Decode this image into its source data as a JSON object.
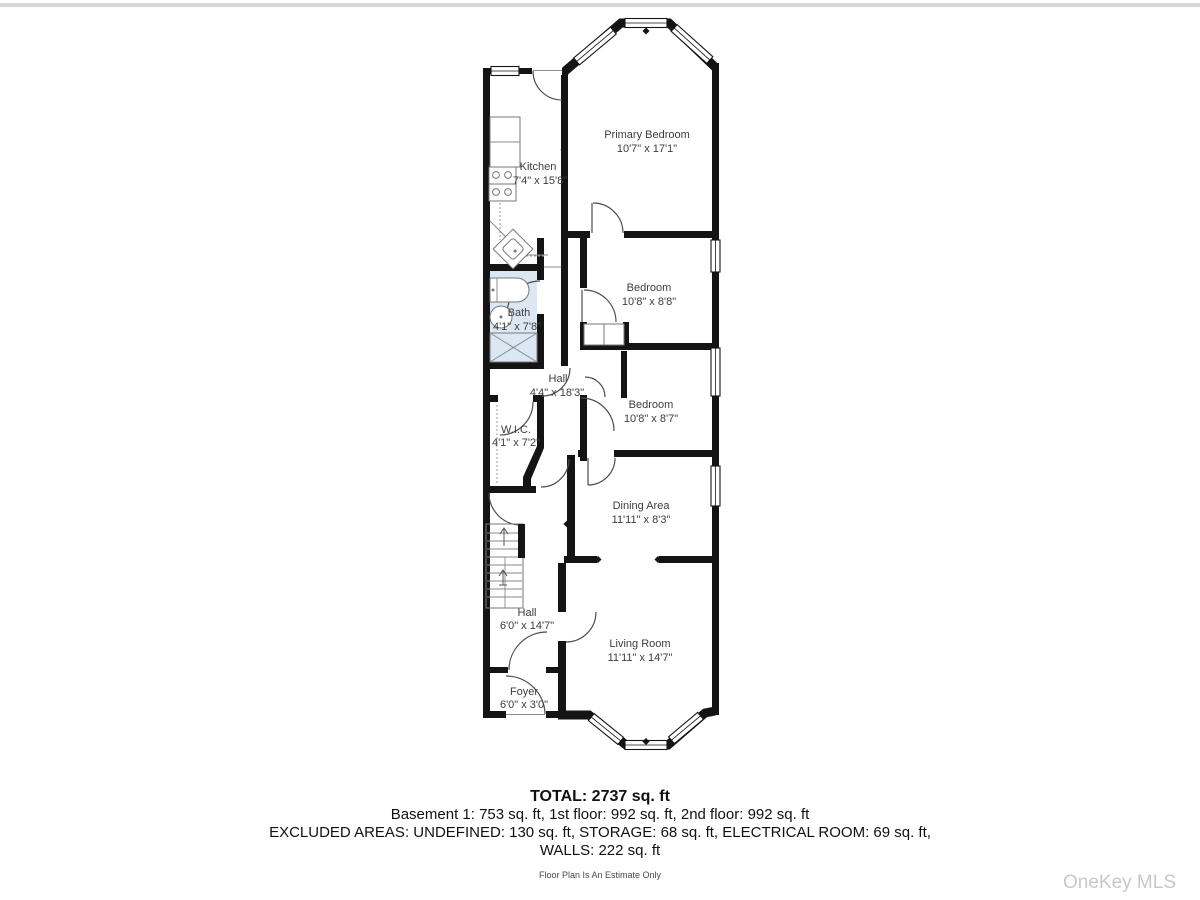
{
  "page": {
    "watermark": "OneKey MLS",
    "disclaimer": "Floor Plan Is An Estimate Only"
  },
  "summary": {
    "total": "TOTAL: 2737 sq. ft",
    "floors": "Basement 1: 753 sq. ft, 1st floor: 992 sq. ft, 2nd floor: 992 sq. ft",
    "excluded": "EXCLUDED AREAS: UNDEFINED: 130 sq. ft, STORAGE: 68 sq. ft, ELECTRICAL ROOM: 69 sq. ft,",
    "walls": "WALLS: 222 sq. ft"
  },
  "rooms": {
    "kitchen": {
      "name": "Kitchen",
      "dims": "7'4\" x 15'8\""
    },
    "primary_bedroom": {
      "name": "Primary Bedroom",
      "dims": "10'7\" x 17'1\""
    },
    "bedroom1": {
      "name": "Bedroom",
      "dims": "10'8\" x 8'8\""
    },
    "bath": {
      "name": "Bath",
      "dims": "4'1\" x 7'8\""
    },
    "hall_upper": {
      "name": "Hall",
      "dims": "4'4\" x 18'3\""
    },
    "bedroom2": {
      "name": "Bedroom",
      "dims": "10'8\" x 8'7\""
    },
    "wic": {
      "name": "W.I.C.",
      "dims": "4'1\" x 7'2\""
    },
    "dining": {
      "name": "Dining Area",
      "dims": "11'11\" x 8'3\""
    },
    "hall_lower": {
      "name": "Hall",
      "dims": "6'0\" x 14'7\""
    },
    "living": {
      "name": "Living Room",
      "dims": "11'11\" x 14'7\""
    },
    "foyer": {
      "name": "Foyer",
      "dims": "6'0\" x 3'0\""
    }
  },
  "colors": {
    "wall": "#141414",
    "bath_fill": "#dbe7f3",
    "label": "#3d3d3d",
    "watermark": "#c6c9cc",
    "top_bar": "#d7d7d7"
  }
}
